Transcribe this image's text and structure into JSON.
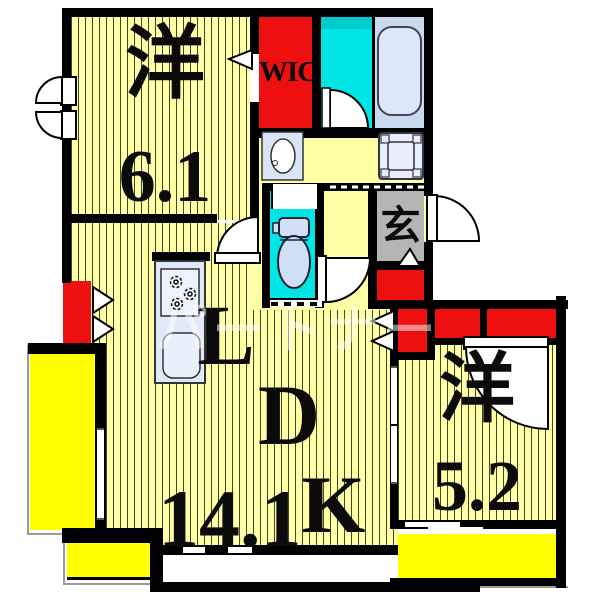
{
  "floorplan": {
    "rooms": {
      "bedroom_main": {
        "name": "洋",
        "size": "6.1"
      },
      "living": {
        "l": "L",
        "d": "D",
        "size_num": "14.1",
        "size_k": "K"
      },
      "bedroom_second": {
        "name": "洋",
        "size": "5.2"
      },
      "entrance": {
        "name": "玄"
      },
      "wic": {
        "name": "WIC"
      }
    },
    "watermark": {
      "text": "パートナー"
    },
    "colors": {
      "floor_yellow": "#ffffa6",
      "balcony_yellow": "#ffff00",
      "closet_red": "#ee1010",
      "washroom_cyan": "#00e6e6",
      "bath_blue": "#c9daf0",
      "entrance_gray": "#b5b5b5",
      "wall_black": "#000000"
    }
  }
}
